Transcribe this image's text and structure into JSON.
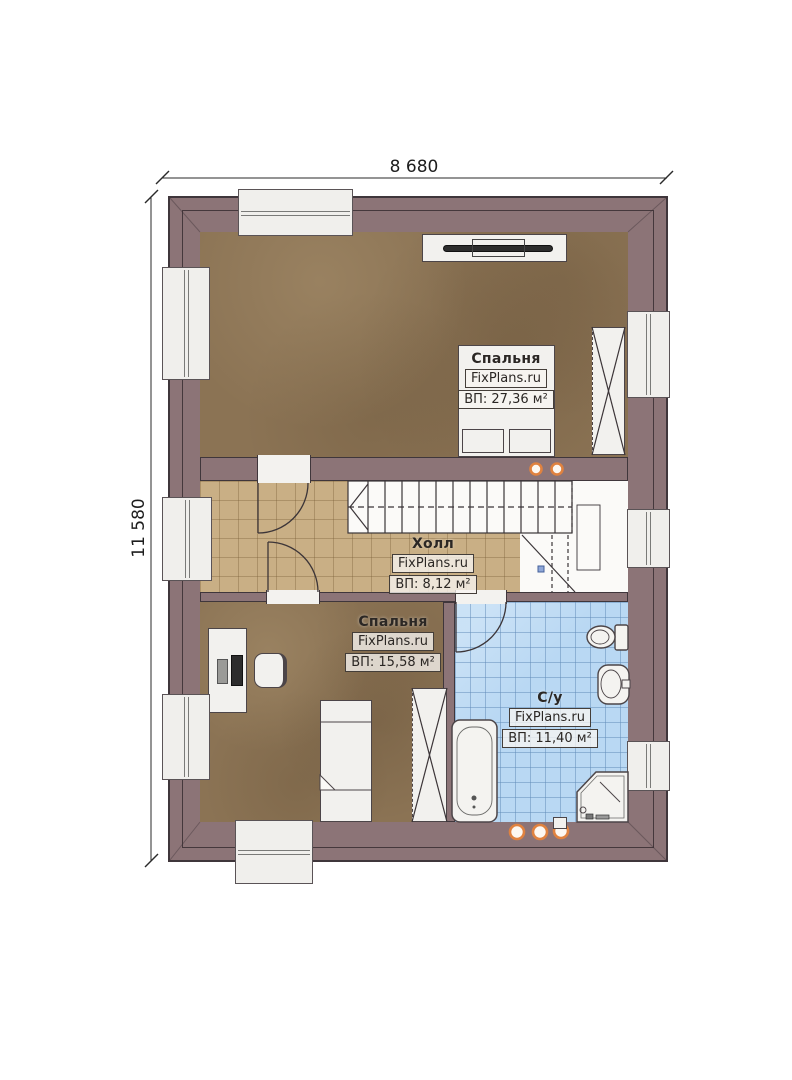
{
  "plan": {
    "dimension_top": "8 680",
    "dimension_left": "11 580",
    "watermark": "FixPlans.ru",
    "rooms": [
      {
        "name": "Спальня",
        "area": "ВП: 27,36 м²"
      },
      {
        "name": "Холл",
        "area": "ВП: 8,12 м²"
      },
      {
        "name": "Спальня",
        "area": "ВП: 15,58 м²"
      },
      {
        "name": "С/у",
        "area": "ВП: 11,40 м²"
      }
    ],
    "colors": {
      "wall": "#8c7477",
      "bedroom_floor": "#8b7354",
      "hall_floor": "#c9af85",
      "bathroom_floor": "#b9d8f3",
      "marker_ring": "#e0823f"
    }
  }
}
